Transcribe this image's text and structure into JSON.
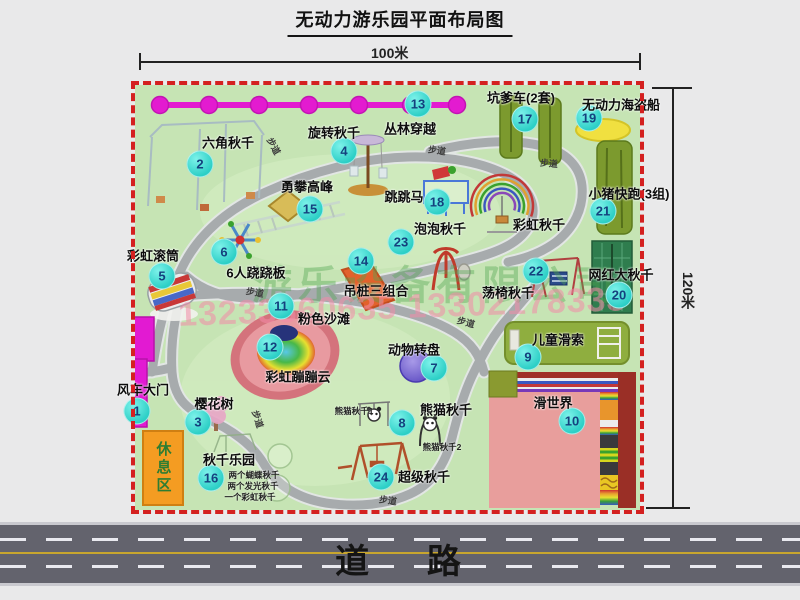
{
  "title": "无动力游乐园平面布局图",
  "dimensions": {
    "width_label": "100米",
    "height_label": "120米"
  },
  "road": {
    "label": "道    路"
  },
  "watermark": {
    "company": "游乐设备有限公司",
    "phone": "13233860635 13302178333"
  },
  "rest_area": {
    "label": "休息区"
  },
  "colors": {
    "map_green": "#c6e4b4",
    "border_red": "#d42020",
    "marker_cyan": "#2ccfc6",
    "gate_magenta": "#e21ad2",
    "chain_magenta": "#e31bd0",
    "road_gray": "#63636d",
    "road_yellow": "#c8a62e",
    "rest_orange": "#f49c22",
    "equipment_olive": "#7c9a2e",
    "slide_salmon": "#e89e9c",
    "watermark_green": "rgba(80,165,80,0.40)",
    "watermark_pink": "rgba(242,138,168,0.55)"
  },
  "attractions": [
    {
      "num": "1",
      "name": "风车大门",
      "marker": [
        137,
        411
      ],
      "label": [
        143,
        389
      ]
    },
    {
      "num": "2",
      "name": "六角秋千",
      "marker": [
        200,
        164
      ],
      "label": [
        228,
        142
      ]
    },
    {
      "num": "3",
      "name": "樱花树",
      "marker": [
        198,
        422
      ],
      "label": [
        214,
        403
      ]
    },
    {
      "num": "4",
      "name": "旋转秋千",
      "marker": [
        344,
        151
      ],
      "label": [
        334,
        132
      ]
    },
    {
      "num": "5",
      "name": "彩虹滚筒",
      "marker": [
        162,
        276
      ],
      "label": [
        153,
        255
      ]
    },
    {
      "num": "6",
      "name": "6人跷跷板",
      "marker": [
        224,
        252
      ],
      "label": [
        256,
        272
      ]
    },
    {
      "num": "7",
      "name": "动物转盘",
      "marker": [
        434,
        368
      ],
      "label": [
        414,
        349
      ]
    },
    {
      "num": "8",
      "name": "熊猫秋千",
      "marker": [
        402,
        423
      ],
      "label": [
        446,
        409
      ]
    },
    {
      "num": "9",
      "name": "儿童滑索",
      "marker": [
        528,
        357
      ],
      "label": [
        558,
        339
      ]
    },
    {
      "num": "10",
      "name": "滑世界",
      "marker": [
        572,
        421
      ],
      "label": [
        553,
        402
      ]
    },
    {
      "num": "11",
      "name": "粉色沙滩",
      "marker": [
        281,
        306
      ],
      "label": [
        324,
        318
      ]
    },
    {
      "num": "12",
      "name": "彩虹蹦蹦云",
      "marker": [
        270,
        347
      ],
      "label": [
        298,
        376
      ]
    },
    {
      "num": "13",
      "name": "丛林穿越",
      "marker": [
        418,
        104
      ],
      "label": [
        410,
        128
      ]
    },
    {
      "num": "14",
      "name": "吊桩三组合",
      "marker": [
        361,
        261
      ],
      "label": [
        376,
        290
      ]
    },
    {
      "num": "15",
      "name": "勇攀高峰",
      "marker": [
        310,
        209
      ],
      "label": [
        307,
        186
      ]
    },
    {
      "num": "16",
      "name": "秋千乐园",
      "marker": [
        211,
        478
      ],
      "label": [
        229,
        459
      ]
    },
    {
      "num": "17",
      "name": "坑爹车(2套)",
      "marker": [
        525,
        119
      ],
      "label": [
        521,
        97
      ]
    },
    {
      "num": "18",
      "name": "跳跳马",
      "marker": [
        437,
        202
      ],
      "label": [
        404,
        196
      ]
    },
    {
      "num": "19",
      "name": "无动力海盗船",
      "marker": [
        589,
        118
      ],
      "label": [
        621,
        104
      ]
    },
    {
      "num": "20",
      "name": "网红大秋千",
      "marker": [
        619,
        295
      ],
      "label": [
        621,
        274
      ]
    },
    {
      "num": "21",
      "name": "小猪快跑(3组)",
      "marker": [
        603,
        211
      ],
      "label": [
        629,
        193
      ]
    },
    {
      "num": "22",
      "name": "荡椅秋千",
      "marker": [
        536,
        271
      ],
      "label": [
        508,
        292
      ]
    },
    {
      "num": "23",
      "name": "泡泡秋千",
      "marker": [
        401,
        242
      ],
      "label": [
        440,
        228
      ]
    },
    {
      "num": "24",
      "name": "超级秋千",
      "marker": [
        381,
        477
      ],
      "label": [
        424,
        476
      ]
    },
    {
      "num": null,
      "name": "彩虹秋千",
      "marker": null,
      "label": [
        539,
        224
      ]
    }
  ],
  "sub_labels": [
    {
      "text": "熊猫秋千1",
      "pos": [
        354,
        411
      ]
    },
    {
      "text": "熊猫秋千2",
      "pos": [
        442,
        447
      ]
    },
    {
      "text": "两个蝴蝶秋千",
      "pos": [
        254,
        475
      ]
    },
    {
      "text": "两个发光秋千",
      "pos": [
        253,
        486
      ]
    },
    {
      "text": "一个彩虹秋千",
      "pos": [
        250,
        497
      ]
    }
  ],
  "path_labels": [
    {
      "text": "步道",
      "pos": [
        274,
        146
      ],
      "rot": 62
    },
    {
      "text": "步道",
      "pos": [
        437,
        150
      ],
      "rot": 8
    },
    {
      "text": "步道",
      "pos": [
        549,
        163
      ],
      "rot": 5
    },
    {
      "text": "步道",
      "pos": [
        255,
        292
      ],
      "rot": 10
    },
    {
      "text": "步道",
      "pos": [
        466,
        322
      ],
      "rot": 15
    },
    {
      "text": "步道",
      "pos": [
        258,
        419
      ],
      "rot": 72
    },
    {
      "text": "步道",
      "pos": [
        388,
        500
      ],
      "rot": 8
    }
  ]
}
